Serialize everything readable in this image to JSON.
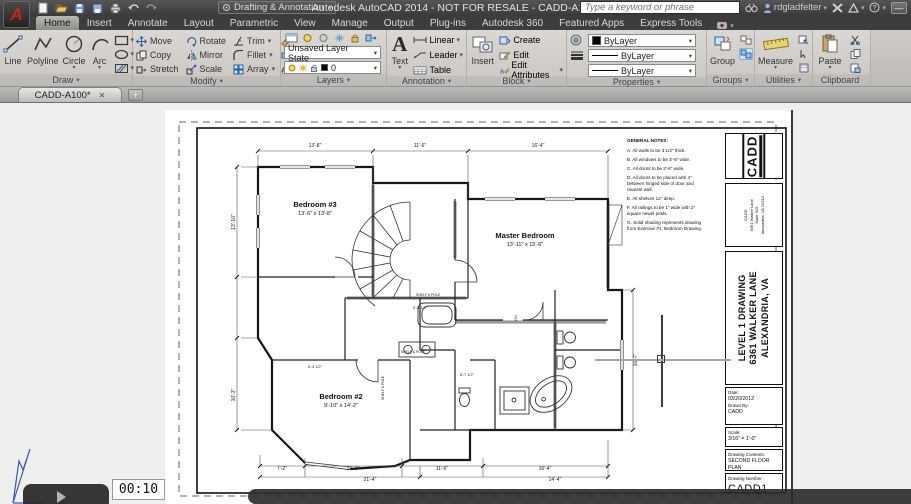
{
  "titlebar": {
    "workspace": "Drafting & Annotation",
    "title": "Autodesk AutoCAD 2014 - NOT FOR RESALE -  CADD-A100.dwg",
    "search_placeholder": "Type a keyword or phrase",
    "username": "rdgladfelter",
    "minimize_glyph": "—",
    "help_glyph": "?"
  },
  "icons": {
    "dropdown": "▾",
    "close": "✕",
    "new_tab": "+",
    "play": "play-triangle"
  },
  "colors": {
    "logo_red": "#c8231b",
    "highlight_blue": "#cfe6f8",
    "ribbon_bg": "#d6d3ce",
    "canvas_bg": "#eef0f0"
  },
  "ribbon": {
    "tabs": [
      {
        "label": "Home",
        "active": true
      },
      {
        "label": "Insert",
        "active": false
      },
      {
        "label": "Annotate",
        "active": false
      },
      {
        "label": "Layout",
        "active": false
      },
      {
        "label": "Parametric",
        "active": false
      },
      {
        "label": "View",
        "active": false
      },
      {
        "label": "Manage",
        "active": false
      },
      {
        "label": "Output",
        "active": false
      },
      {
        "label": "Plug-ins",
        "active": false
      },
      {
        "label": "Autodesk 360",
        "active": false
      },
      {
        "label": "Featured Apps",
        "active": false
      },
      {
        "label": "Express Tools",
        "active": false
      }
    ],
    "draw": {
      "title": "Draw",
      "line": "Line",
      "polyline": "Polyline",
      "circle": "Circle",
      "arc": "Arc"
    },
    "modify": {
      "title": "Modify",
      "buttons": [
        "Move",
        "Rotate",
        "Trim",
        "Copy",
        "Mirror",
        "Fillet",
        "Stretch",
        "Scale",
        "Array"
      ]
    },
    "layers": {
      "title": "Layers",
      "layer_state": "Unsaved Layer State",
      "current_layer": "0"
    },
    "annotation": {
      "title": "Annotation",
      "text": "Text",
      "linear": "Linear",
      "leader": "Leader",
      "table": "Table"
    },
    "block": {
      "title": "Block",
      "insert": "Insert",
      "create": "Create",
      "edit": "Edit",
      "edit_attributes": "Edit Attributes"
    },
    "properties": {
      "title": "Properties",
      "color": "ByLayer",
      "linetype": "ByLayer",
      "lineweight": "ByLayer"
    },
    "groups": {
      "title": "Groups",
      "group": "Group"
    },
    "utilities": {
      "title": "Utilities",
      "measure": "Measure"
    },
    "clipboard": {
      "title": "Clipboard",
      "paste": "Paste"
    }
  },
  "file_tab": {
    "name": "CADD-A100*"
  },
  "sheet": {
    "notes_title": "GENERAL NOTES:",
    "notes": [
      "A. All walls to be 3 1/2\" thick.",
      "B. All windows to be 3'-6\" wide.",
      "C. All doors to be 2'-6\" wide.",
      "D. All doors to be placed with 4\" between hinged side of door and nearest wall.",
      "E. All shelves 12\" deep.",
      "F. All railings to be 1\" wide with 2\" square newel posts.",
      "G. Solid shading represents drawing from Exercise #1: Bedroom Drawing."
    ],
    "rooms": {
      "bedroom3": {
        "name": "Bedroom #3",
        "size": "13'-6\" x 13'-8\""
      },
      "master": {
        "name": "Master Bedroom",
        "size": "13'-11\" x 15'-6\""
      },
      "bedroom2": {
        "name": "Bedroom #2",
        "size": "9'-10\" x 14'-2\""
      }
    },
    "plan_labels": [
      {
        "t": "13'-8\"",
        "x": 150,
        "y": 37
      },
      {
        "t": "11'-6\"",
        "x": 255,
        "y": 37
      },
      {
        "t": "16'-4\"",
        "x": 373,
        "y": 37
      },
      {
        "t": "7'-2\"",
        "x": 117,
        "y": 360
      },
      {
        "t": "13'-8\"",
        "x": 188,
        "y": 360
      },
      {
        "t": "11'-6\"",
        "x": 277,
        "y": 360
      },
      {
        "t": "16'-4\"",
        "x": 380,
        "y": 360
      },
      {
        "t": "21'-4\"",
        "x": 205,
        "y": 371
      },
      {
        "t": "14'-4\"",
        "x": 390,
        "y": 371
      },
      {
        "t": "13'-10\"",
        "x": 70,
        "y": 112,
        "r": -90
      },
      {
        "t": "10'-3\"",
        "x": 70,
        "y": 285,
        "r": -90
      },
      {
        "t": "16'-7\"",
        "x": 472,
        "y": 250,
        "r": -90
      },
      {
        "t": "5'-8 1/2\"",
        "x": 255,
        "y": 199,
        "s": 3.8
      },
      {
        "t": "8'-7 1/2\"",
        "x": 302,
        "y": 266,
        "s": 3.8
      },
      {
        "t": "6'-4 1/2\"",
        "x": 150,
        "y": 258,
        "s": 3.8
      },
      {
        "t": "SHELF & POLE",
        "x": 263,
        "y": 186,
        "s": 3.4
      },
      {
        "t": "SHELF & POLE",
        "x": 248,
        "y": 243,
        "s": 3.4
      },
      {
        "t": "SHELF & POLE",
        "x": 219,
        "y": 278,
        "s": 3.4,
        "r": -90
      },
      {
        "t": "DN",
        "x": 352,
        "y": 208,
        "s": 4,
        "r": -90
      }
    ],
    "title_block": {
      "logo": "CADD",
      "firm_lines": [
        "CADD",
        "6361 Walker Lane",
        "Suite 310",
        "Alexandria, VA 22310"
      ],
      "project_lines": [
        "LEVEL 1 DRAWING",
        "6361 WALKER LANE",
        "ALEXANDRIA, VA"
      ],
      "date_label": "Date:",
      "date": "03/20/2012",
      "drawn_by_label": "Drawn By:",
      "drawn_by": "CADD",
      "scale_label": "Scale:",
      "scale": "3/16\" = 1'-0\"",
      "contents_label": "Drawing Contents:",
      "contents": "SECOND FLOOR PLAN",
      "number_label": "Drawing Number:",
      "number": "CADD1"
    }
  },
  "player": {
    "time": "00:10"
  }
}
